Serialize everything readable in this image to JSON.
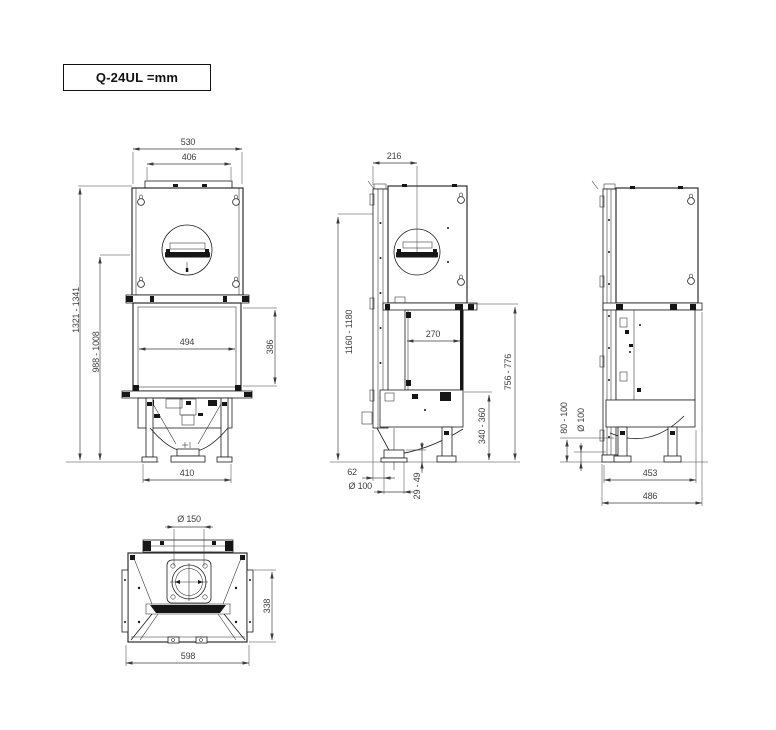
{
  "title": {
    "label": "Q-24UL =mm"
  },
  "views": {
    "front": {
      "dims": {
        "top_width": "530",
        "top_plate_width": "406",
        "overall_height": "1321 - 1341",
        "flue_center_height": "988 - 1008",
        "glass_width": "494",
        "glass_height": "386",
        "feet_spacing": "410"
      }
    },
    "side_left": {
      "dims": {
        "flue_center_depth": "216",
        "front_frame_height": "1160 - 1180",
        "glass_depth": "270",
        "firebox_top_height": "756 - 776",
        "clearance_height": "340 - 360",
        "outlet_offset": "62",
        "outlet_diameter": "Ø 100",
        "outlet_stub_height": "29 - 49"
      }
    },
    "side_right": {
      "dims": {
        "inlet_height_range": "80 - 100",
        "inlet_diameter": "Ø 100",
        "feet_depth": "453",
        "overall_depth": "486"
      }
    },
    "bottom": {
      "dims": {
        "flue_diameter": "Ø 150",
        "depth": "338",
        "width": "598"
      }
    }
  }
}
